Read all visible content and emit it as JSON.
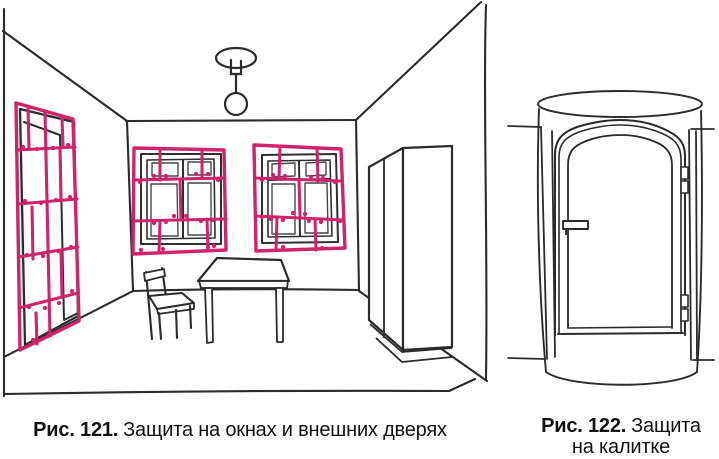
{
  "page": {
    "background": "#ffffff"
  },
  "colors": {
    "ink": "#2b2b2b",
    "ink_light": "#4a4a4a",
    "grille_pink": "#d02369",
    "caption_text": "#111111"
  },
  "figures": {
    "room": {
      "caption_label": "Рис. 121.",
      "caption_text": "Защита на окнах и внешних дверях"
    },
    "gate": {
      "caption_label": "Рис. 122.",
      "caption_text": "Защита",
      "caption_text_line2": "на калитке"
    }
  }
}
